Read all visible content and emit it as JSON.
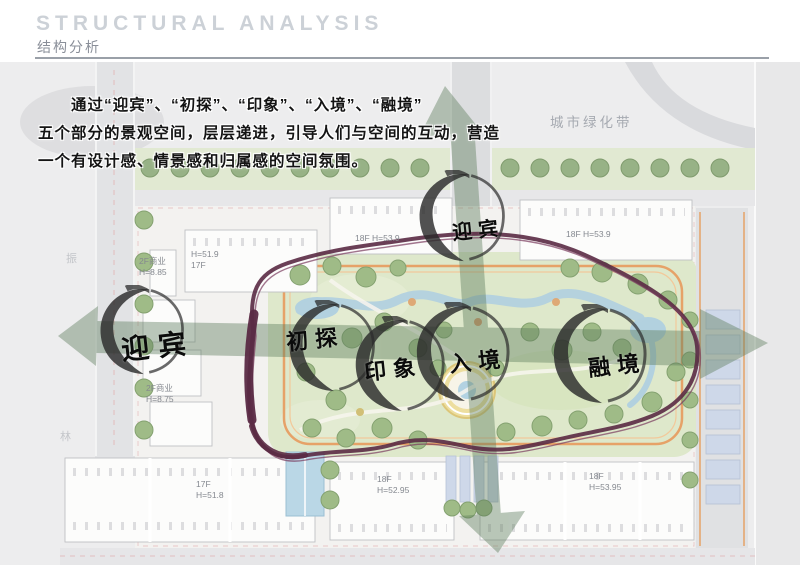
{
  "header": {
    "title": "STRUCTURAL ANALYSIS",
    "subtitle": "结构分析"
  },
  "description": {
    "lines": [
      "　　通过“迎宾”、“初探”、“印象”、“入境”、“融境”",
      "五个部分的景观空间，层层递进，引导人们与空间的互动，营造",
      "一个有设计感、情景感和归属感的空间氛围。"
    ]
  },
  "plan": {
    "green_belt_label": "城市绿化带",
    "zones": [
      {
        "id": "yingbin-top",
        "label": "迎宾"
      },
      {
        "id": "yingbin-left",
        "label": "迎宾"
      },
      {
        "id": "chutan",
        "label": "初探"
      },
      {
        "id": "yinxiang",
        "label": "印象"
      },
      {
        "id": "rujing",
        "label": "入境"
      },
      {
        "id": "rongjing",
        "label": "融境"
      }
    ],
    "building_labels": [
      "2F商业\nH=8.85",
      "H=51.9\n17F",
      "18F H=53.9",
      "18F H=53.9",
      "2F商业\nH=8.75",
      "17F\nH=51.8",
      "18F\nH=52.95",
      "18F\nH=53.95"
    ],
    "side_texts": [
      "振",
      "林"
    ]
  },
  "colors": {
    "arrow_green": "#5d7c5c",
    "loop_maroon": "#5a2a44",
    "brush_black": "#2b2b2b",
    "accent_orange": "#e2924e"
  }
}
